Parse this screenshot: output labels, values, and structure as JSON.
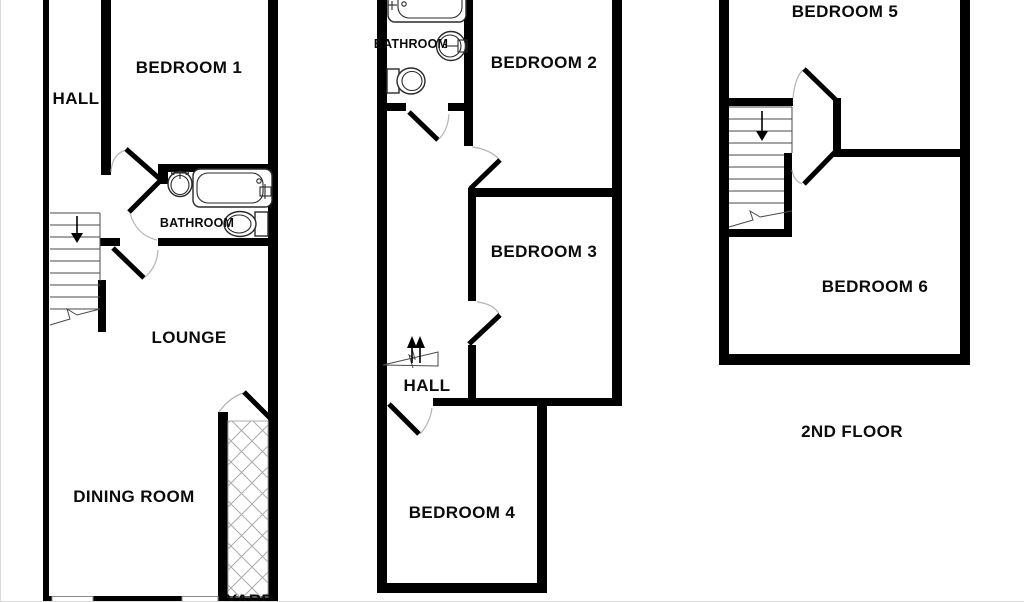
{
  "title": "Floor plan",
  "plans": {
    "ground": {
      "rooms": {
        "hall": "HALL",
        "bedroom1": "BEDROOM 1",
        "bathroom": "BATHROOM",
        "lounge": "LOUNGE",
        "dining_room": "DINING ROOM",
        "yard": "YARD"
      }
    },
    "first": {
      "rooms": {
        "bathroom": "BATHROOM",
        "bedroom2": "BEDROOM 2",
        "bedroom3": "BEDROOM 3",
        "hall": "HALL",
        "bedroom4": "BEDROOM 4"
      }
    },
    "second": {
      "rooms": {
        "bedroom5": "BEDROOM 5",
        "bedroom6": "BEDROOM 6"
      },
      "floor_label": "2ND FLOOR"
    }
  },
  "colors": {
    "wall": "#000000",
    "background": "#ffffff",
    "hatch_line": "#ababab",
    "fixture_line": "#2a2a2a",
    "door_swing": "#b4b4b4"
  }
}
